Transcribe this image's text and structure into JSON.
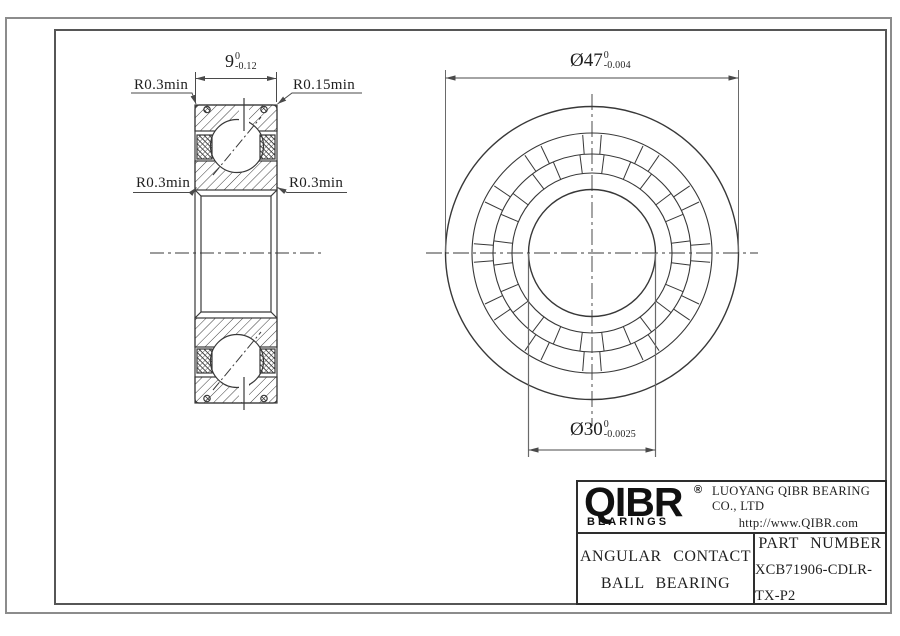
{
  "sheet": {
    "background": "#ffffff",
    "outer_border_color": "#8c8c8c",
    "inner_border_color": "#565656",
    "line_color": "#383838"
  },
  "cross_section_view": {
    "width_dim": {
      "value": "9",
      "tol_upper": "0",
      "tol_lower": "-0.12"
    },
    "fillet_top_left": "R0.3min",
    "fillet_top_right": "R0.15min",
    "fillet_mid_left": "R0.3min",
    "fillet_mid_right": "R0.3min"
  },
  "front_view": {
    "outer_diameter_dim": {
      "value": "Ø47",
      "tol_upper": "0",
      "tol_lower": "-0.004"
    },
    "bore_diameter_dim": {
      "value": "Ø30",
      "tol_upper": "0",
      "tol_lower": "-0.0025"
    }
  },
  "title_block": {
    "logo_text": "QIBR",
    "logo_registered": "®",
    "logo_subtext": "BEARINGS",
    "company_name": "LUOYANG QIBR BEARING CO., LTD",
    "website": "http://www.QIBR.com",
    "product_type_line1": "ANGULAR CONTACT",
    "product_type_line2": "BALL BEARING",
    "part_number_label": "PART NUMBER",
    "part_number": "XCB71906-CDLR-TX-P2"
  }
}
